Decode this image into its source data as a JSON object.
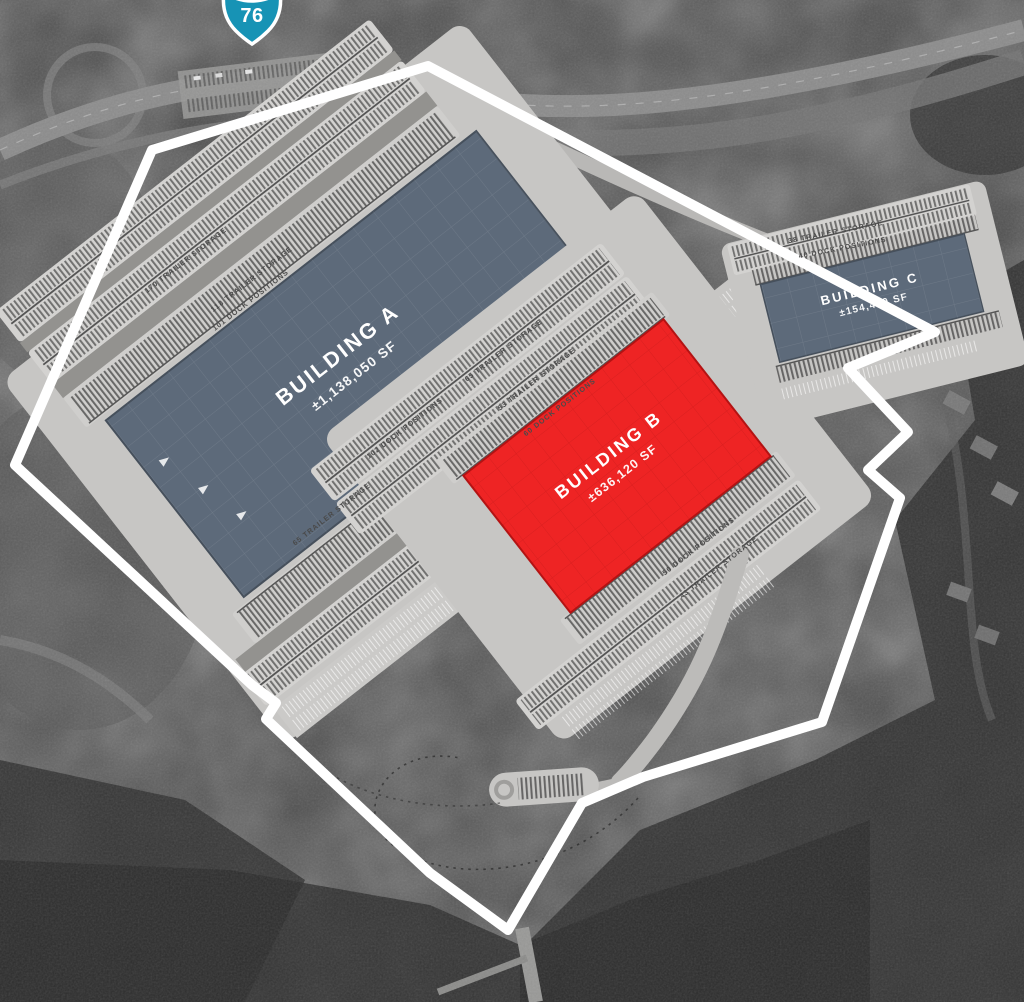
{
  "site_plan": {
    "highway_shield": {
      "number": "76",
      "color": "#1793b5"
    },
    "buildings": [
      {
        "name": "BUILDING A",
        "area": "±1,138,050 SF",
        "color": "#5d6a7a"
      },
      {
        "name": "BUILDING B",
        "area": "±636,120 SF",
        "color": "#ee2424"
      },
      {
        "name": "BUILDING C",
        "area": "±154,440 SF",
        "color": "#5d6a7a"
      }
    ],
    "labels": [
      {
        "text": "170 TRAILER STORAGE"
      },
      {
        "text": "118 TRAILER STORAGE"
      },
      {
        "text": "101 DOCK POSITIONS"
      },
      {
        "text": "102 DOCK POSITIONS"
      },
      {
        "text": "65 TRAILER STORAGE"
      },
      {
        "text": "65 TRAILER STORAGE"
      },
      {
        "text": "53 TRAILER STORAGE"
      },
      {
        "text": "60 DOCK POSITIONS"
      },
      {
        "text": "50 DOCK POSITIONS"
      },
      {
        "text": "43 TRAILER STORAGE"
      },
      {
        "text": "38 TRAILER STORAGE"
      },
      {
        "text": "40 DOCK POSITIONS"
      }
    ],
    "boundary_color": "#ffffff"
  }
}
